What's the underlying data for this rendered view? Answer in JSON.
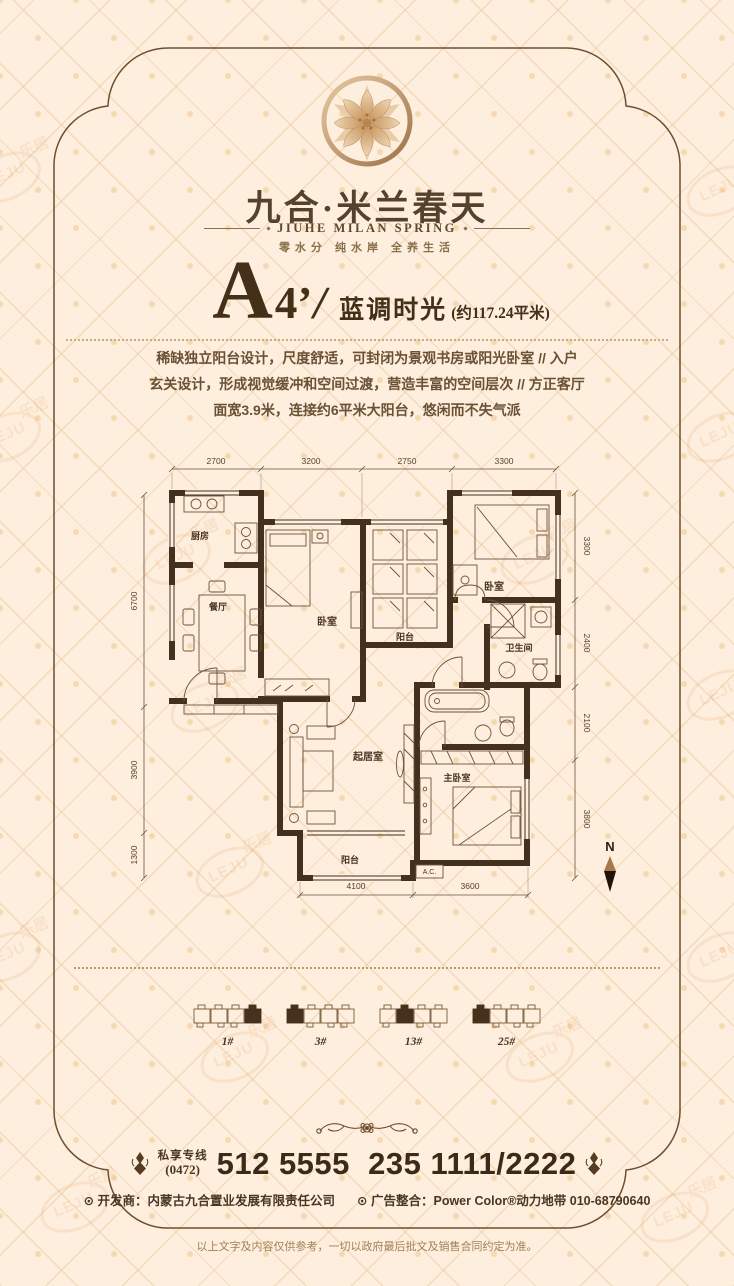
{
  "brand": {
    "title": "九合·米兰春天",
    "subtitle": "JIUHE MILAN SPRING",
    "tagline": "零水分 纯水岸 全养生活"
  },
  "unit": {
    "letter": "A",
    "number": "4’",
    "slash": "/",
    "name": "蓝调时光",
    "area": "(约117.24平米)",
    "description": "稀缺独立阳台设计，尺度舒适，可封闭为景观书房或阳光卧室 // 入户\n玄关设计，形成视觉缓冲和空间过渡，营造丰富的空间层次 // 方正客厅\n面宽3.9米，连接约6平米大阳台，悠闲而不失气派"
  },
  "floorplan": {
    "dims_top": [
      "2700",
      "3200",
      "2750",
      "3300"
    ],
    "dims_left": [
      "6700",
      "3900",
      "1300"
    ],
    "dims_right": [
      "3300",
      "2400",
      "2100",
      "3800"
    ],
    "dims_bottom": [
      "4100",
      "3600"
    ],
    "rooms": {
      "kitchen": "厨房",
      "dining": "餐厅",
      "bedroom_left": "卧室",
      "balcony_top": "阳台",
      "bedroom_right": "卧室",
      "bathroom": "卫生间",
      "living": "起居室",
      "master": "主卧室",
      "balcony_bottom": "阳台",
      "ac": "A.C."
    },
    "compass": "N"
  },
  "buildings": [
    {
      "label": "1#"
    },
    {
      "label": "3#"
    },
    {
      "label": "13#"
    },
    {
      "label": "25#"
    }
  ],
  "contact": {
    "hotline_label": "私享专线",
    "area_code": "(0472)",
    "phone": "512 5555  235 1111/2222",
    "developer": "⊙ 开发商：内蒙古九合置业发展有限责任公司",
    "agency": "⊙ 广告整合：Power Color®动力地带 010-68790640"
  },
  "disclaimer": "以上文字及内容仅供参考，一切以政府最后批文及销售合同约定为准。",
  "watermark": {
    "cn": "乐居",
    "en": "LEJU"
  },
  "colors": {
    "brown": "#44301e",
    "gold": "#c89a6a",
    "bg": "#fdeedd"
  }
}
